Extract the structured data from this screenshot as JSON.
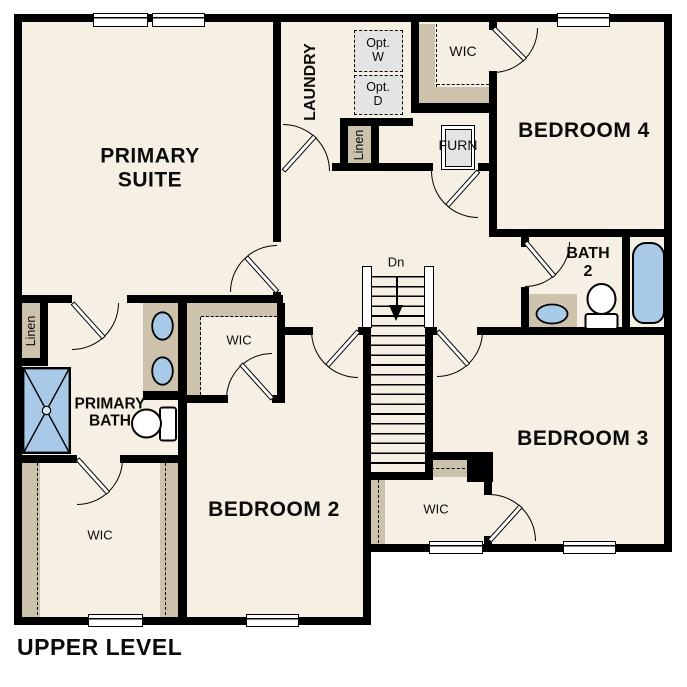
{
  "title": "UPPER LEVEL",
  "colors": {
    "wall": "#000000",
    "floor": "#f6f0e4",
    "shelf": "#cdc3ac",
    "fixture_blue": "#a9c9e8",
    "appliance_gray": "#e4e4e4"
  },
  "rooms": {
    "primary_suite": {
      "line1": "PRIMARY",
      "line2": "SUITE"
    },
    "laundry": {
      "label": "LAUNDRY"
    },
    "opt_washer": {
      "line1": "Opt.",
      "line2": "W"
    },
    "opt_dryer": {
      "line1": "Opt.",
      "line2": "D"
    },
    "wic_bedroom4": {
      "label": "WIC"
    },
    "bedroom4": {
      "label": "BEDROOM 4"
    },
    "furnace": {
      "label": "FURN"
    },
    "linen_hall": {
      "label": "Linen"
    },
    "linen_primary": {
      "label": "Linen"
    },
    "stairs": {
      "label": "Dn"
    },
    "bath2": {
      "line1": "BATH",
      "line2": "2"
    },
    "primary_bath": {
      "line1": "PRIMARY",
      "line2": "BATH"
    },
    "wic_bedroom2": {
      "label": "WIC"
    },
    "wic_primary": {
      "label": "WIC"
    },
    "bedroom2": {
      "label": "BEDROOM 2"
    },
    "bedroom3": {
      "label": "BEDROOM 3"
    },
    "wic_bedroom3": {
      "label": "WIC"
    }
  }
}
